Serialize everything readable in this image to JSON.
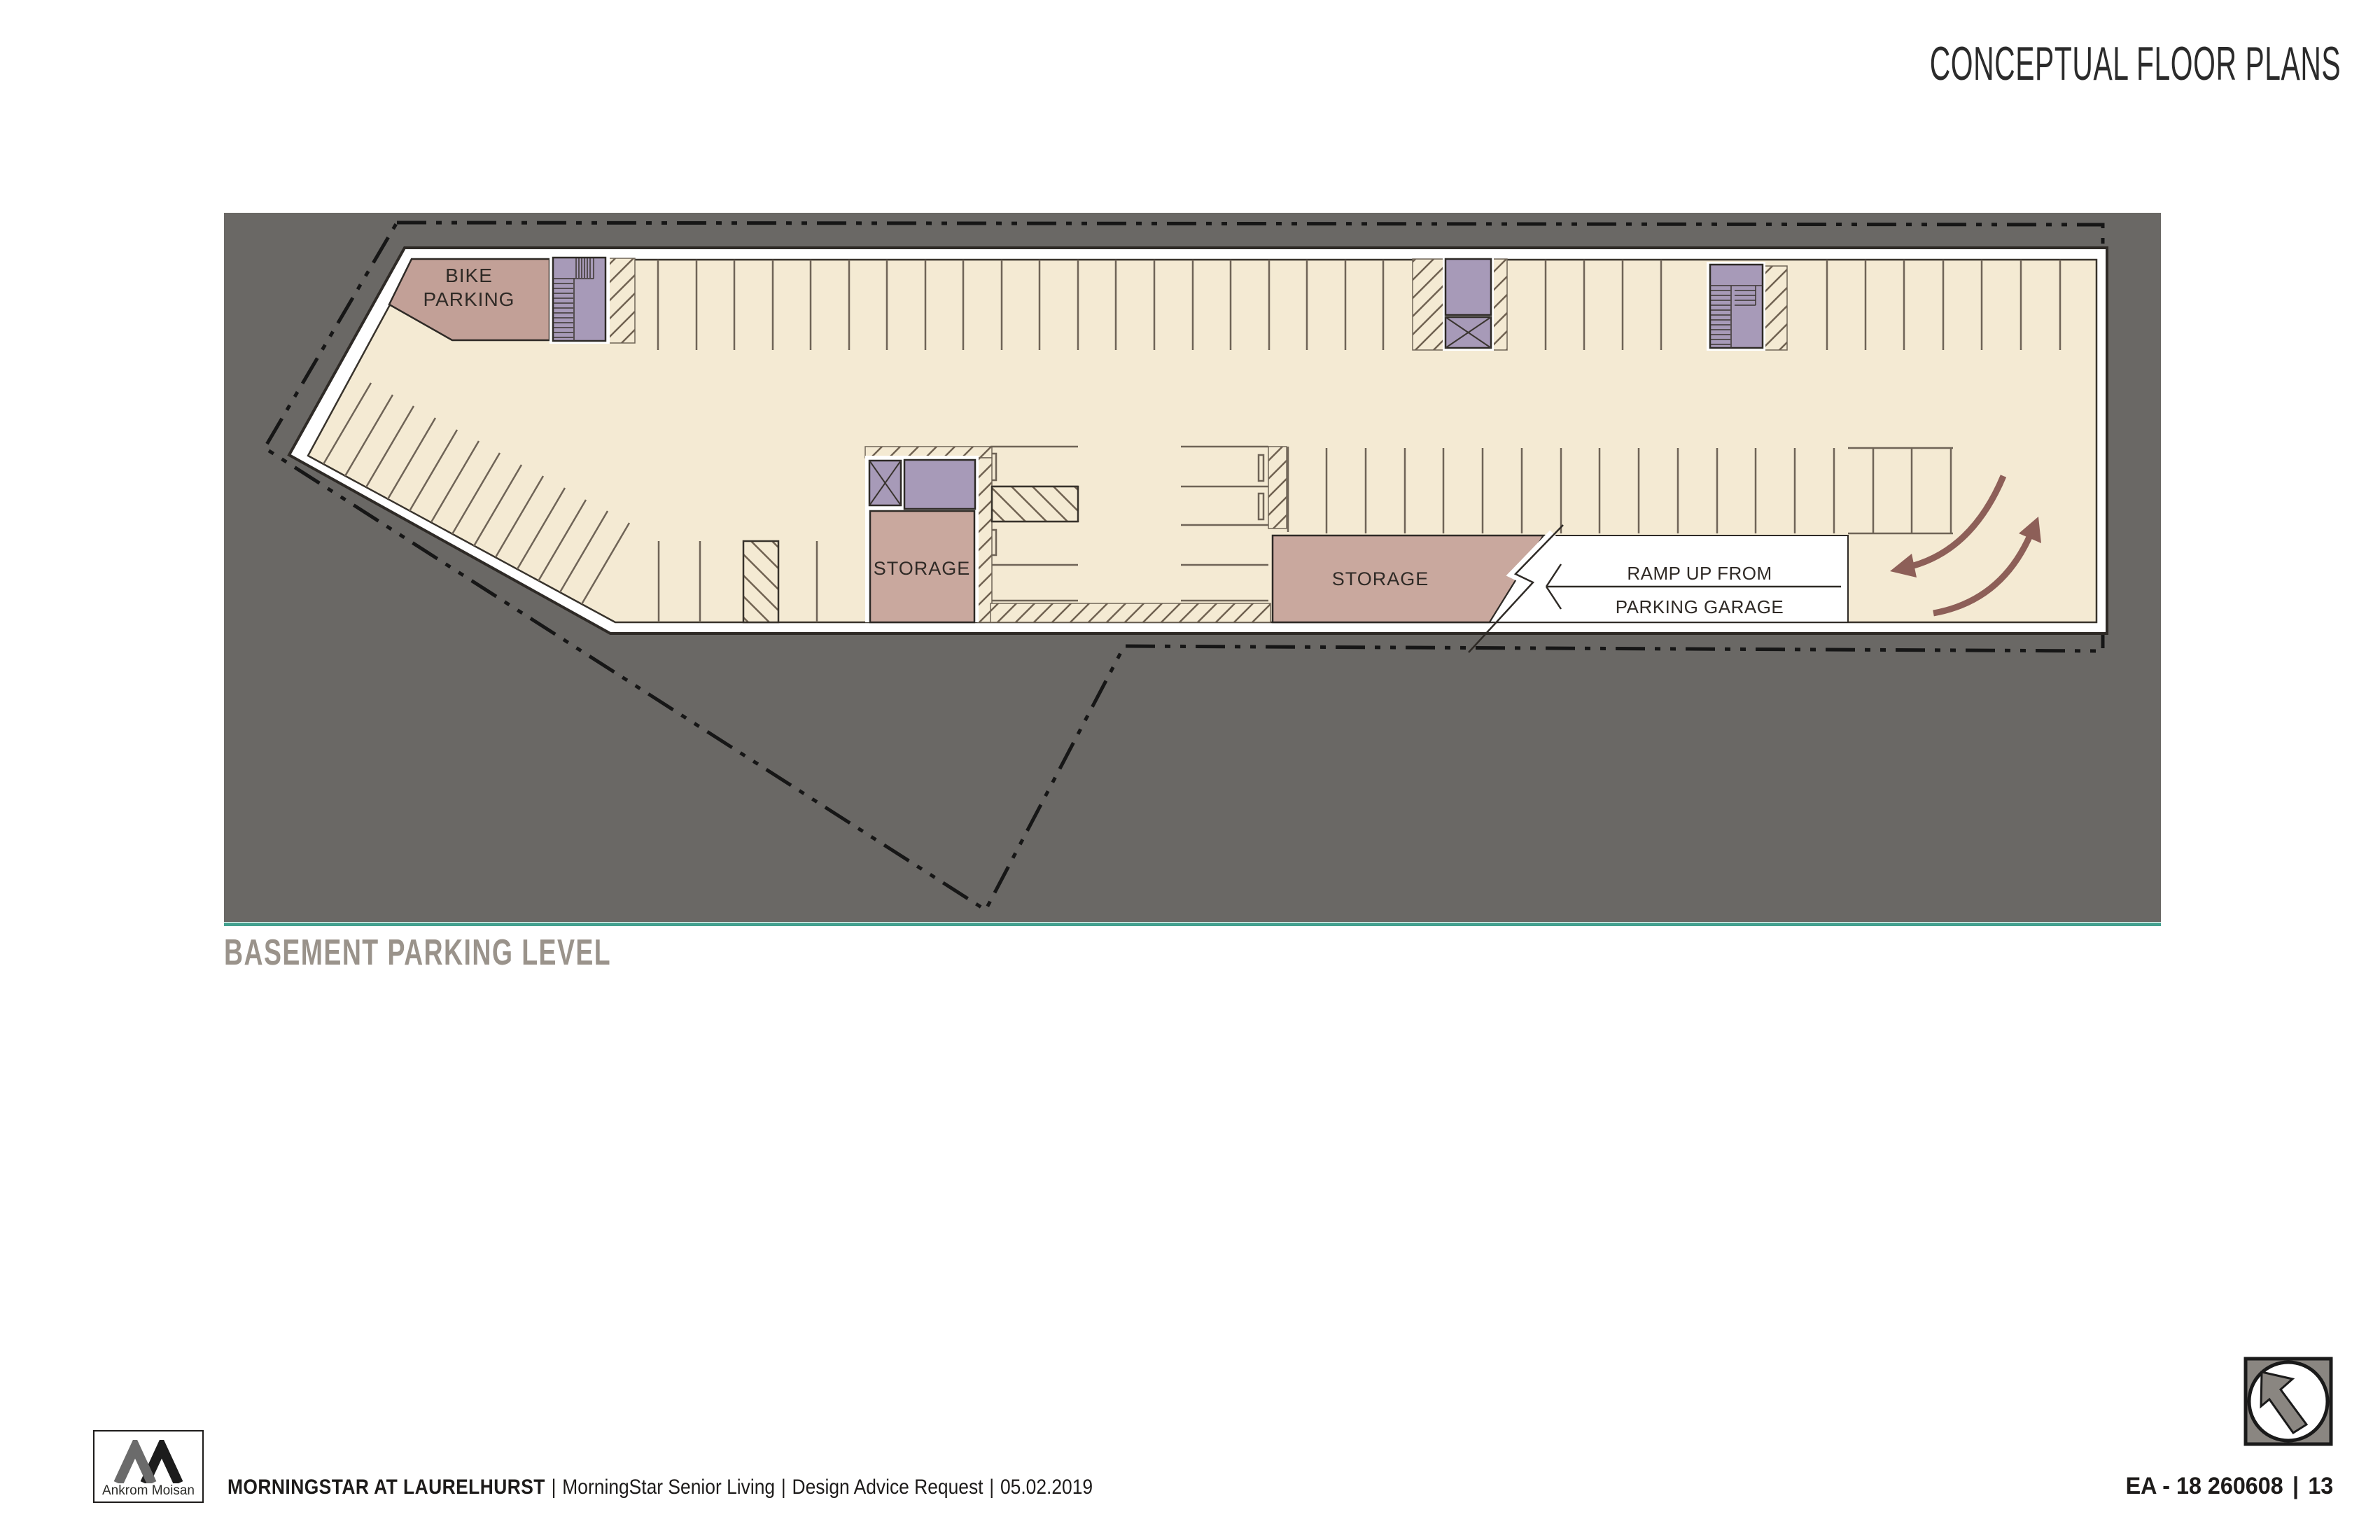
{
  "header": {
    "title": "CONCEPTUAL FLOOR PLANS"
  },
  "plan": {
    "heading": "BASEMENT PARKING LEVEL",
    "labels": {
      "bike_line1": "BIKE",
      "bike_line2": "PARKING",
      "storage_central": "STORAGE",
      "storage_east": "STORAGE",
      "ramp_line1": "RAMP UP FROM",
      "ramp_line2": "PARKING GARAGE"
    }
  },
  "footer": {
    "logo_caption": "Ankrom Moisan",
    "project": "MORNINGSTAR AT LAURELHURST",
    "separator": "|",
    "client": "MorningStar Senior Living",
    "phase": "Design Advice Request",
    "date": "05.02.2019",
    "sheet_number": "EA - 18 260608",
    "page_separator": "|",
    "page": "13"
  },
  "colors": {
    "accent_teal": "#43a18f",
    "canvas_gray": "#6a6865",
    "floor_cream": "#f4ead3",
    "room_mauve": "#c9a89e",
    "bike_room_mauve": "#c2a097",
    "core_purple": "#a79ab8",
    "arrow_maroon": "#8d5f58",
    "heading_gray": "#9a938b"
  }
}
